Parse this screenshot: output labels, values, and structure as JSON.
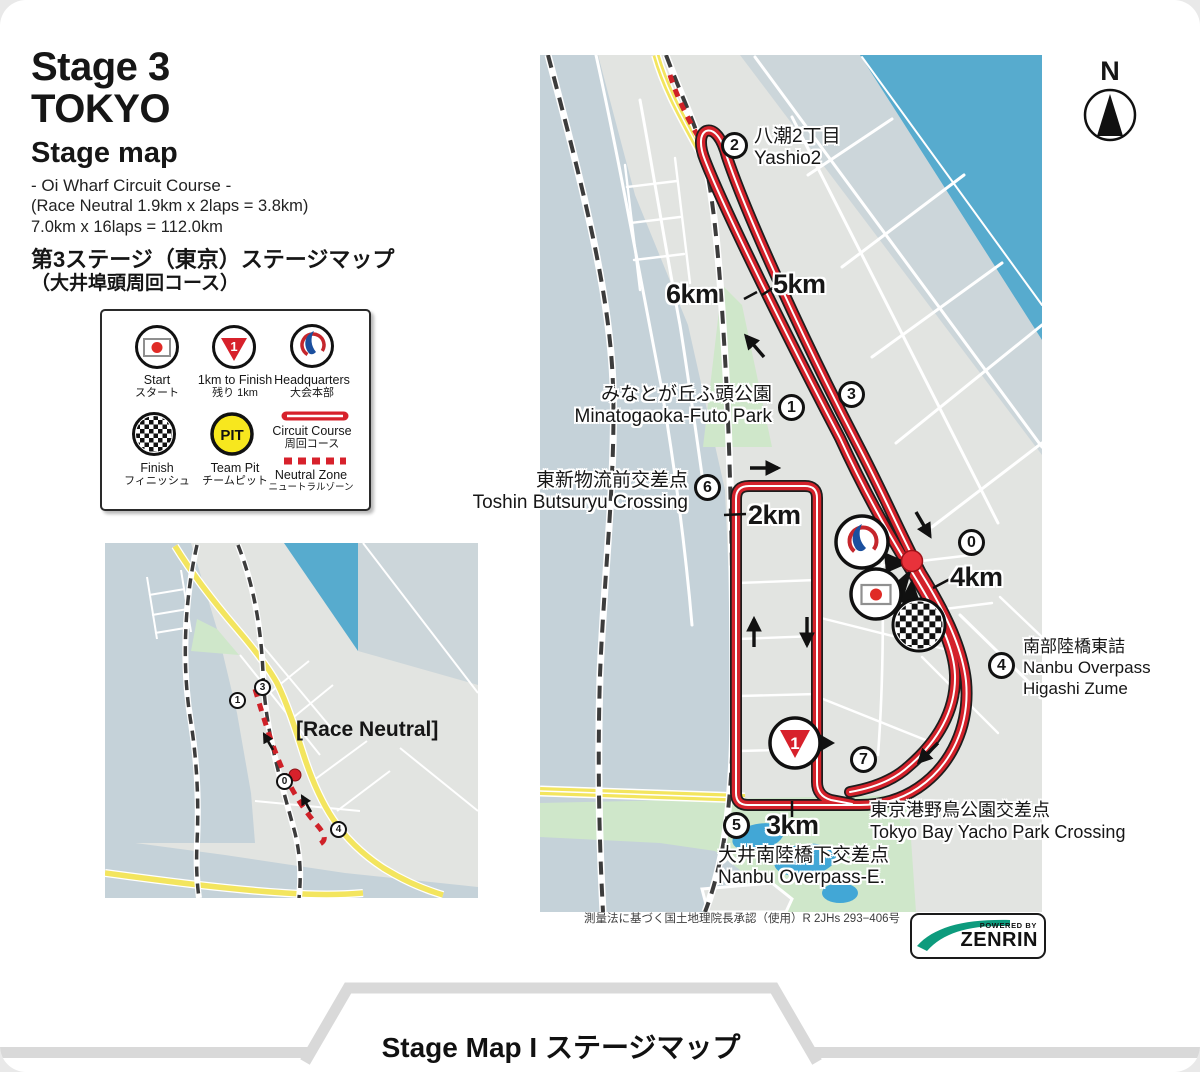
{
  "header": {
    "stage": "Stage 3",
    "city": "TOKYO",
    "subtitle": "Stage map",
    "course_name": "- Oi Wharf Circuit Course -",
    "neutral_info": "(Race Neutral 1.9km x 2laps = 3.8km)",
    "distance_info": "7.0km x 16laps = 112.0km",
    "title_jp": "第3ステージ（東京）ステージマップ",
    "subtitle_jp": "（大井埠頭周回コース）"
  },
  "legend": {
    "items": [
      {
        "en": "Start",
        "jp": "スタート",
        "icon": "start-flag"
      },
      {
        "en": "1km to Finish",
        "jp": "残り 1km",
        "icon": "one-km-triangle",
        "icon_text": "1"
      },
      {
        "en": "Headquarters",
        "jp": "大会本部",
        "icon": "headquarters-logo"
      },
      {
        "en": "Finish",
        "jp": "フィニッシュ",
        "icon": "finish-checkered"
      },
      {
        "en": "Team Pit",
        "jp": "チームピット",
        "icon": "team-pit",
        "icon_text": "PIT"
      },
      {
        "en": "Circuit Course",
        "jp": "周回コース",
        "icon": "circuit-line"
      },
      {
        "en": "Neutral Zone",
        "jp": "ニュートラルゾーン",
        "icon": "neutral-dashes"
      }
    ]
  },
  "main_map": {
    "compass": "N",
    "km_markers": [
      "5km",
      "6km",
      "2km",
      "4km",
      "3km"
    ],
    "checkpoints": {
      "c0": "0",
      "c1": "1",
      "c2": "2",
      "c3": "3",
      "c4": "4",
      "c5": "5",
      "c6": "6",
      "c7": "7"
    },
    "icon_text": {
      "km1": "1"
    },
    "labels": {
      "yashio": {
        "jp": "八潮2丁目",
        "en": "Yashio2"
      },
      "minatogaoka": {
        "jp": "みなとが丘ふ頭公園",
        "en": "Minatogaoka-Futo Park"
      },
      "toshin": {
        "jp": "東新物流前交差点",
        "en": "Toshin Butsuryu Crossing"
      },
      "nanbu_higashi": {
        "jp": "南部陸橋東詰",
        "en1": "Nanbu Overpass",
        "en2": "Higashi Zume"
      },
      "yacho": {
        "jp": "東京港野鳥公園交差点",
        "en": "Tokyo Bay Yacho Park Crossing"
      },
      "nanbu_e": {
        "jp": "大井南陸橋下交差点",
        "en": "Nanbu Overpass-E."
      }
    },
    "attribution": "測量法に基づく国土地理院長承認（使用）R 2JHs 293−406号",
    "zenrin": {
      "powered_by": "POWERED BY",
      "brand": "ZENRIN"
    }
  },
  "small_map": {
    "race_neutral": "[Race Neutral]",
    "checkpoints": {
      "c0": "0",
      "c1": "1",
      "c3": "3",
      "c4": "4"
    }
  },
  "footer": {
    "label": "Stage Map I ステージマップ"
  },
  "colors": {
    "course_red": "#d4222b",
    "water_blue": "#57abce",
    "water_gray": "#c5d2d9",
    "land_gray": "#e2e4e1",
    "park_green": "#cfe7ca",
    "road_yellow": "#f3e55e",
    "zenrin_green": "#0d9b7d"
  }
}
